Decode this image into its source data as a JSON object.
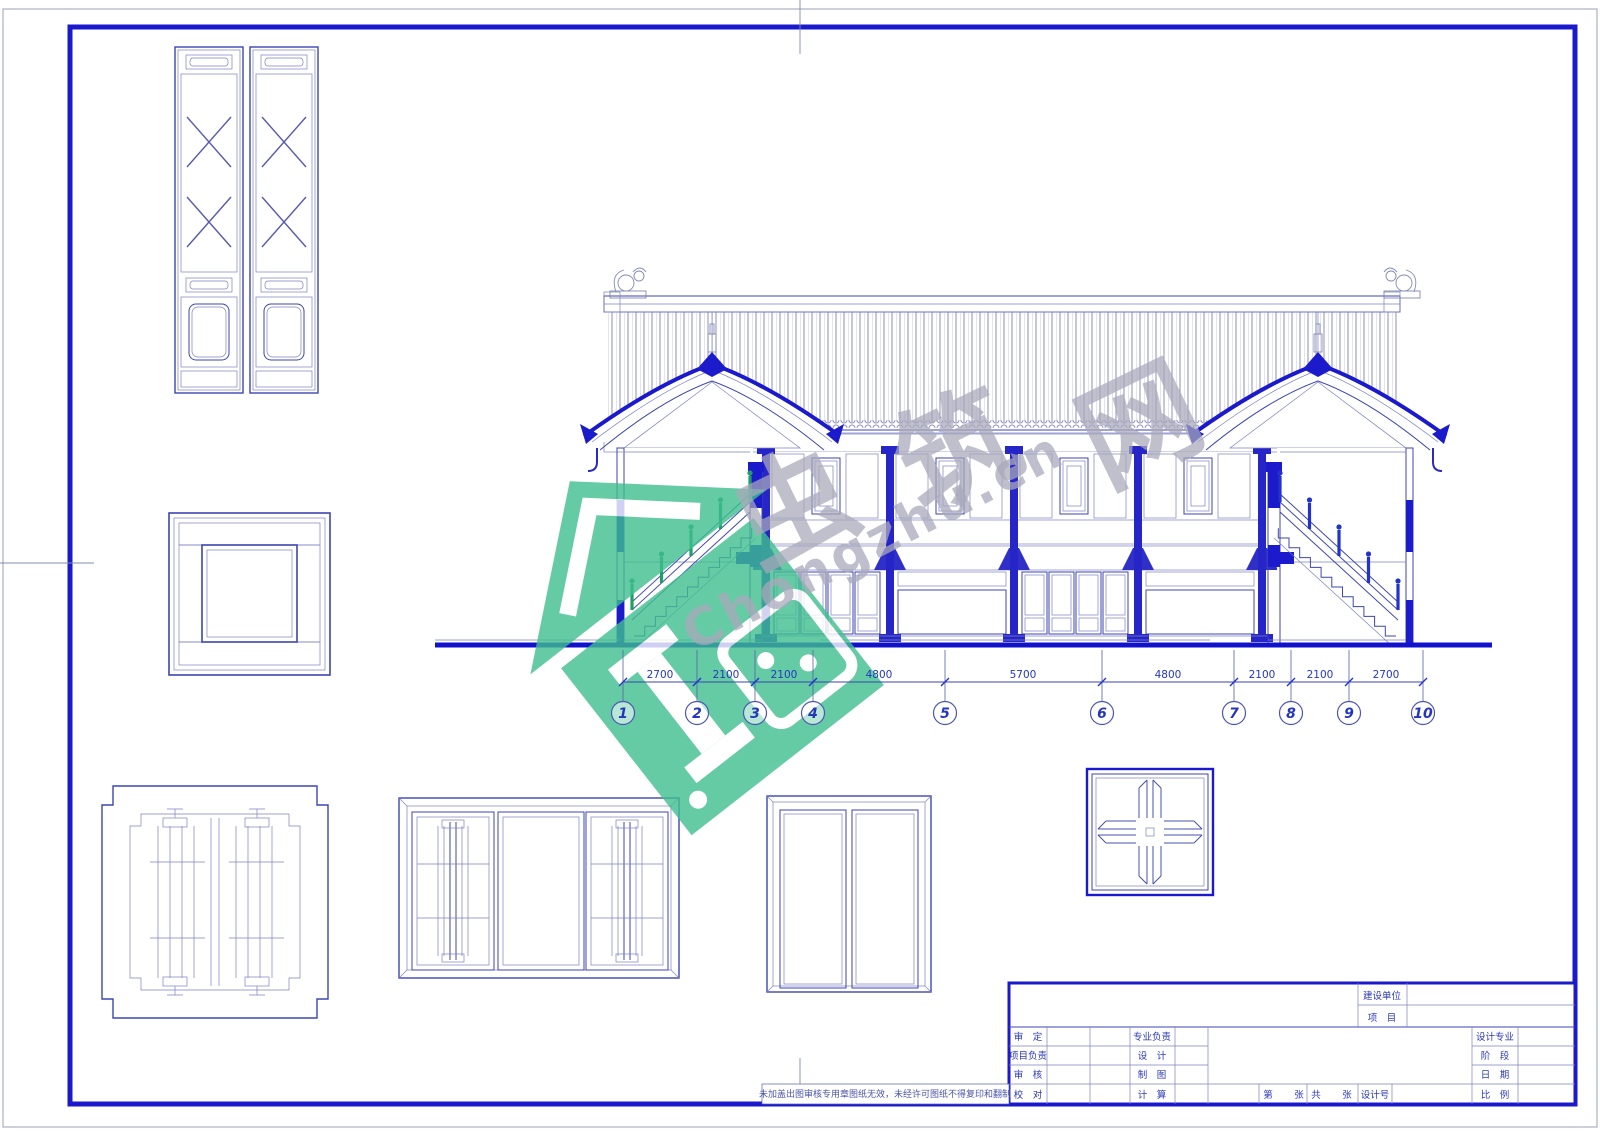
{
  "sheet": {
    "kind": "CAD architectural drawing sheet",
    "background": "#ffffff"
  },
  "colors": {
    "frame_thick_blue": "#1a1acc",
    "line_blue": "#3c46b0",
    "line_thin": "#7b82c0",
    "dense_lattice": "#3b3bc4",
    "stair_rail_left": "#1f9e68",
    "stair_rail_right": "#2233cc",
    "watermark_green": "#3fbf8f",
    "watermark_gray": "#a9a9bb"
  },
  "elevation": {
    "dims": [
      "2700",
      "2100",
      "2100",
      "4800",
      "5700",
      "4800",
      "2100",
      "2100",
      "2700"
    ],
    "grid_labels": [
      "1",
      "2",
      "3",
      "4",
      "5",
      "6",
      "7",
      "8",
      "9",
      "10"
    ]
  },
  "titleblock": {
    "header": {
      "unit_label": "建设单位",
      "project_label": "项　目"
    },
    "rows": [
      {
        "a": "审　定",
        "b": "专业负责",
        "c": "设计专业"
      },
      {
        "a": "项目负责",
        "b": "设　计",
        "c": "阶　段"
      },
      {
        "a": "审　核",
        "b": "制　图",
        "c": "日　期"
      },
      {
        "a": "校　对",
        "b": "计　算",
        "c": "比　例"
      }
    ],
    "sheet": {
      "no_prefix": "第",
      "sheet_word": "张",
      "total_word": "共",
      "design_no_label": "设计号"
    },
    "disclaimer": "未加盖出图审核专用章图纸无效，未经许可图纸不得复印和翻制"
  },
  "watermark": {
    "chars": [
      "虫",
      "筑",
      "网"
    ],
    "brand": "Chongzhu.cn"
  }
}
